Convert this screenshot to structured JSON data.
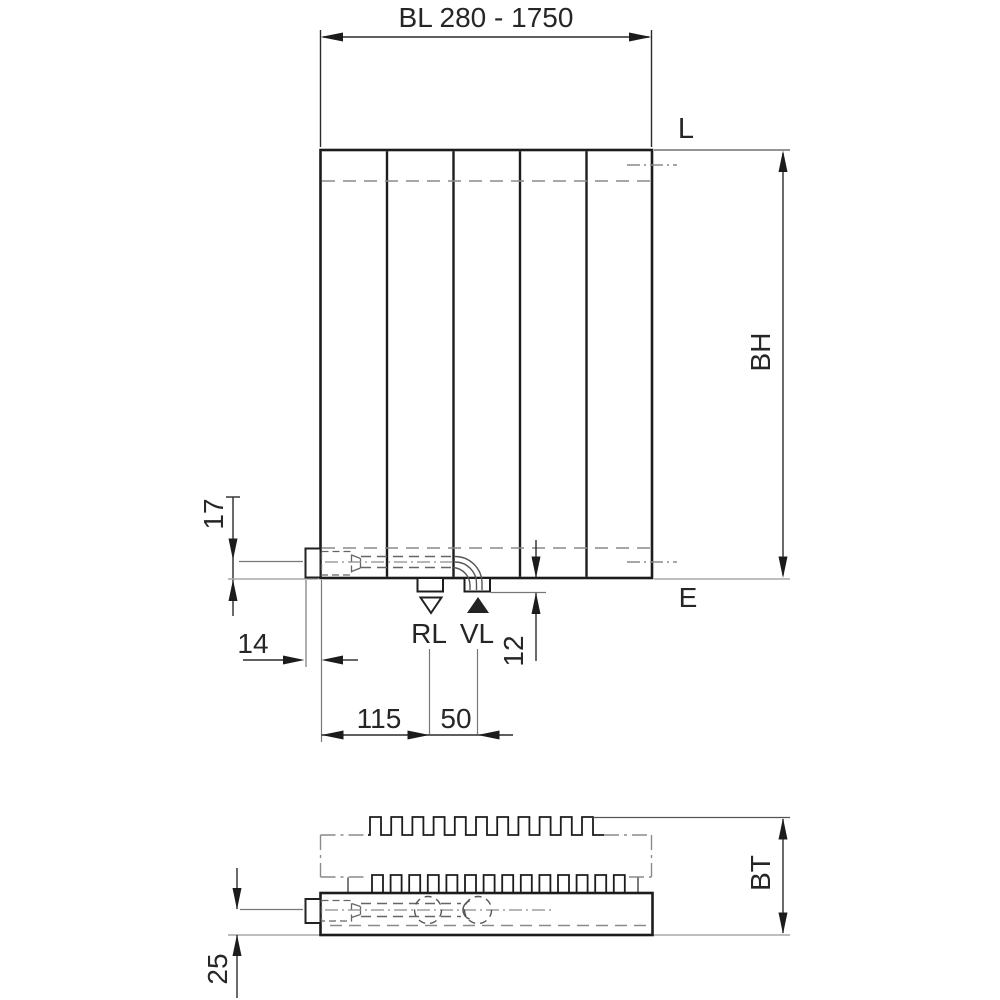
{
  "front_view": {
    "width_dim": "BL 280 - 1750",
    "height_dim": "BH",
    "top_level": "L",
    "bottom_level": "E",
    "return_port": "RL",
    "supply_port": "VL",
    "dim_center_offset": "17",
    "dim_valve_depth": "14",
    "dim_left_to_return": "115",
    "dim_port_spacing": "50",
    "dim_stub_drop": "12"
  },
  "top_view": {
    "depth_dim": "BT",
    "dim_wall_offset": "25"
  },
  "colors": {
    "outline": "#1c1c1c",
    "dimension": "#2a2a2a",
    "hidden_line": "#8a8a8a",
    "reference_line": "#a8a8a8"
  }
}
